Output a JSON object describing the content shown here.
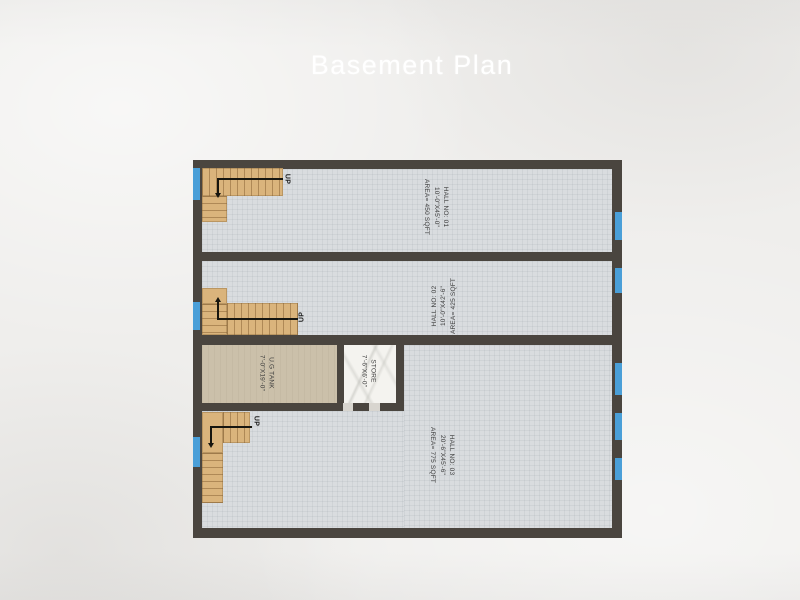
{
  "title": "Basement Plan",
  "colors": {
    "paper": "#edecea",
    "wall": "#4a453f",
    "floor_tile": "#d9dcdf",
    "stairs": "#dab47c",
    "tank_floor": "#cbc0aa",
    "store_floor": "#f4f3ef",
    "window_marker": "#4a9fd8",
    "title_text": "#ffffff",
    "label_text": "#3c3c3c"
  },
  "rooms": {
    "hall1": {
      "name": "HALL NO: 01",
      "dims": "10'-0\"X45'-0\"",
      "area": "AREA= 450 SQFT"
    },
    "hall2": {
      "name": "HALL NO: 02",
      "dims": "10'-0\"X42'-6\"",
      "area": "AREA= 425 SQFT"
    },
    "hall3": {
      "name": "HALL NO: 03",
      "dims": "20'-6\"X45'-6\"",
      "area": "AREA= 775 SQFT"
    },
    "ug_tank": {
      "name": "U.G TANK",
      "dims": "7'-0\"X19'-0\""
    },
    "store": {
      "name": "STORE",
      "dims": "7'-6\"X6'-0\""
    }
  },
  "stairs": {
    "up_label": "UP"
  }
}
